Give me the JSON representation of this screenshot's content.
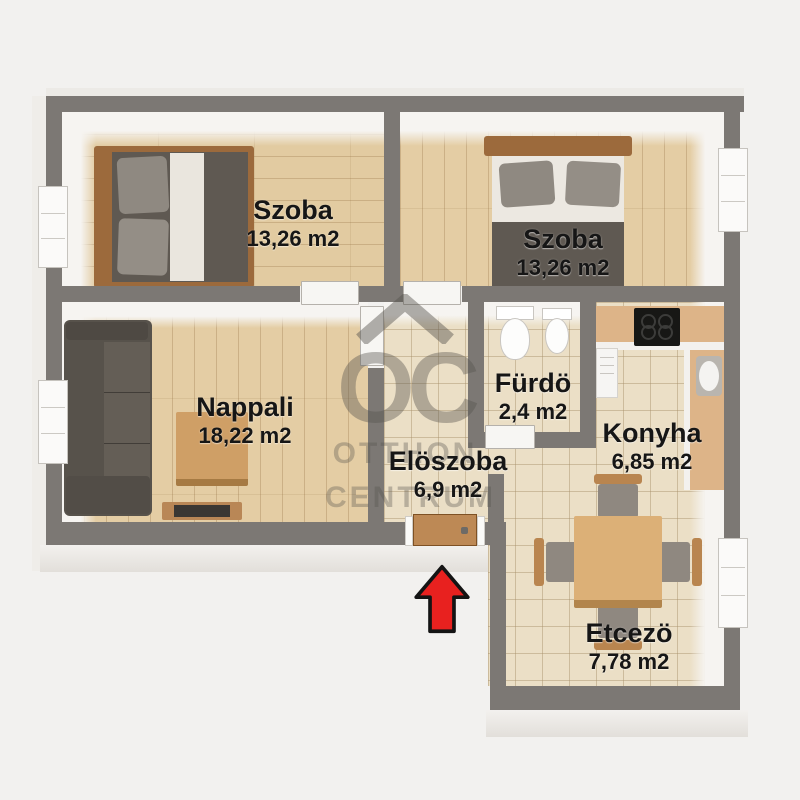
{
  "page": {
    "type": "apartment-floor-plan",
    "language": "Hungarian"
  },
  "watermark": {
    "logo_text": "OC",
    "brand_line1": "OTTHON",
    "brand_line2": "CENTRUM"
  },
  "rooms": [
    {
      "id": "bedroom-1",
      "name": "Szoba",
      "area": "13,26 m2"
    },
    {
      "id": "bedroom-2",
      "name": "Szoba",
      "area": "13,26 m2"
    },
    {
      "id": "living-room",
      "name": "Nappali",
      "area": "18,22 m2"
    },
    {
      "id": "bathroom",
      "name": "Fürdö",
      "area": "2,4 m2"
    },
    {
      "id": "hallway",
      "name": "Elöszoba",
      "area": "6,9 m2"
    },
    {
      "id": "kitchen",
      "name": "Konyha",
      "area": "6,85 m2"
    },
    {
      "id": "dining-room",
      "name": "Etcezö",
      "area": "7,78 m2"
    }
  ],
  "icons": {
    "entrance_arrow": "red-up-arrow",
    "watermark_logo": "house-roof"
  },
  "colors": {
    "background": "#f2f1ef",
    "wall": "#7c7874",
    "wood_floor": "#e2cba1",
    "tile_floor": "#ebdfc6",
    "furniture_dark": "#57524b",
    "furniture_wood": "#cf9f66",
    "arrow_red": "#e8211f",
    "label_text": "#161616",
    "watermark": "#56534e"
  }
}
